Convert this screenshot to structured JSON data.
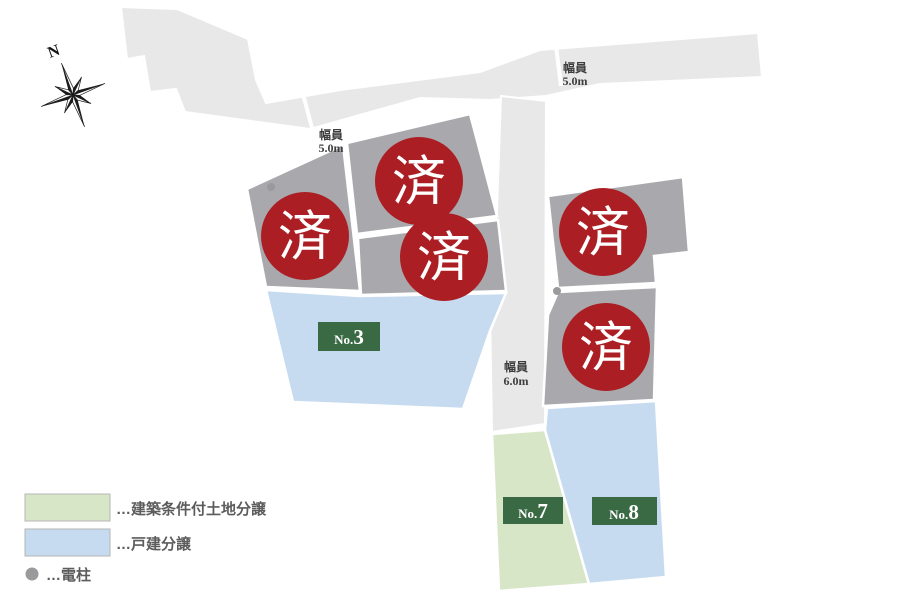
{
  "compass": {
    "label": "N"
  },
  "sold_marker": {
    "text": "済"
  },
  "roads": [
    {
      "name": "north-road",
      "width_label": "幅員",
      "width_value": "5.0m"
    },
    {
      "name": "east-road",
      "width_label": "幅員",
      "width_value": "5.0m"
    },
    {
      "name": "center-road",
      "width_label": "幅員",
      "width_value": "6.0m"
    }
  ],
  "lots": {
    "available": [
      {
        "prefix": "No.",
        "number": "3",
        "category": "戸建分譲"
      },
      {
        "prefix": "No.",
        "number": "7",
        "category": "建築条件付土地分譲"
      },
      {
        "prefix": "No.",
        "number": "8",
        "category": "戸建分譲"
      }
    ],
    "sold_label": "済"
  },
  "legend": {
    "items": [
      {
        "key": "conditional_land",
        "label": "…建築条件付土地分譲"
      },
      {
        "key": "detached_house",
        "label": "…戸建分譲"
      },
      {
        "key": "utility_pole",
        "label": "…電柱"
      }
    ]
  },
  "colors": {
    "road_fill": "#e8e8e9",
    "sold_parcel_fill": "#a9a9ad",
    "sold_circle_fill": "#ab1e23",
    "conditional_land_fill": "#d8e6c8",
    "detached_house_fill": "#c7dbf0",
    "lot_label_bg": "#3a6a44",
    "pole_dot": "#9a9a9c"
  }
}
